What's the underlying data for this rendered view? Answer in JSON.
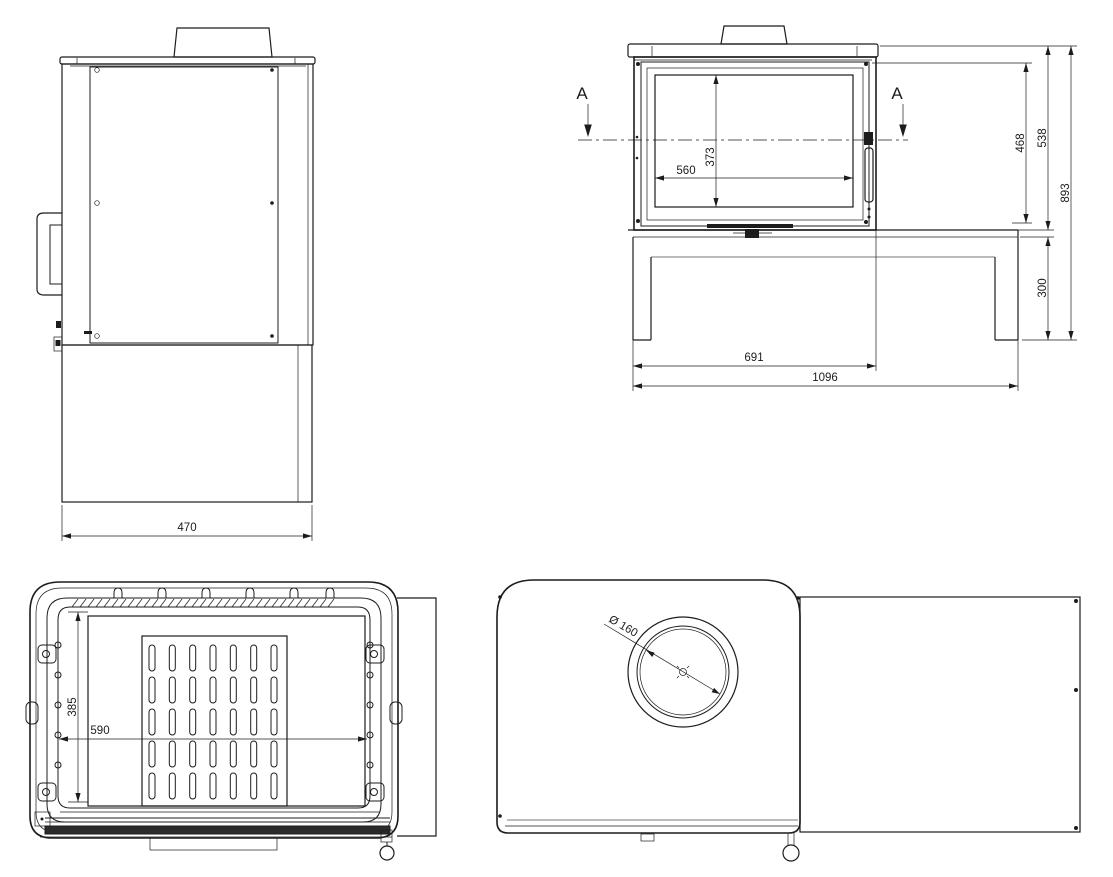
{
  "views": {
    "side": {
      "dim_depth": "470"
    },
    "front": {
      "section_marker": "A",
      "dim_glass_width": "560",
      "dim_glass_height": "373",
      "dim_door_height": "468",
      "dim_body_height": "538",
      "dim_total_height": "893",
      "dim_base_height": "300",
      "dim_body_width": "691",
      "dim_total_width": "1096"
    },
    "section": {
      "dim_opening_height": "385",
      "dim_opening_width": "590"
    },
    "top": {
      "dim_flue_diameter": "Ø 160"
    }
  },
  "colors": {
    "line": "#1c1c1c",
    "line_light": "#7a7a7a",
    "background": "#ffffff"
  }
}
